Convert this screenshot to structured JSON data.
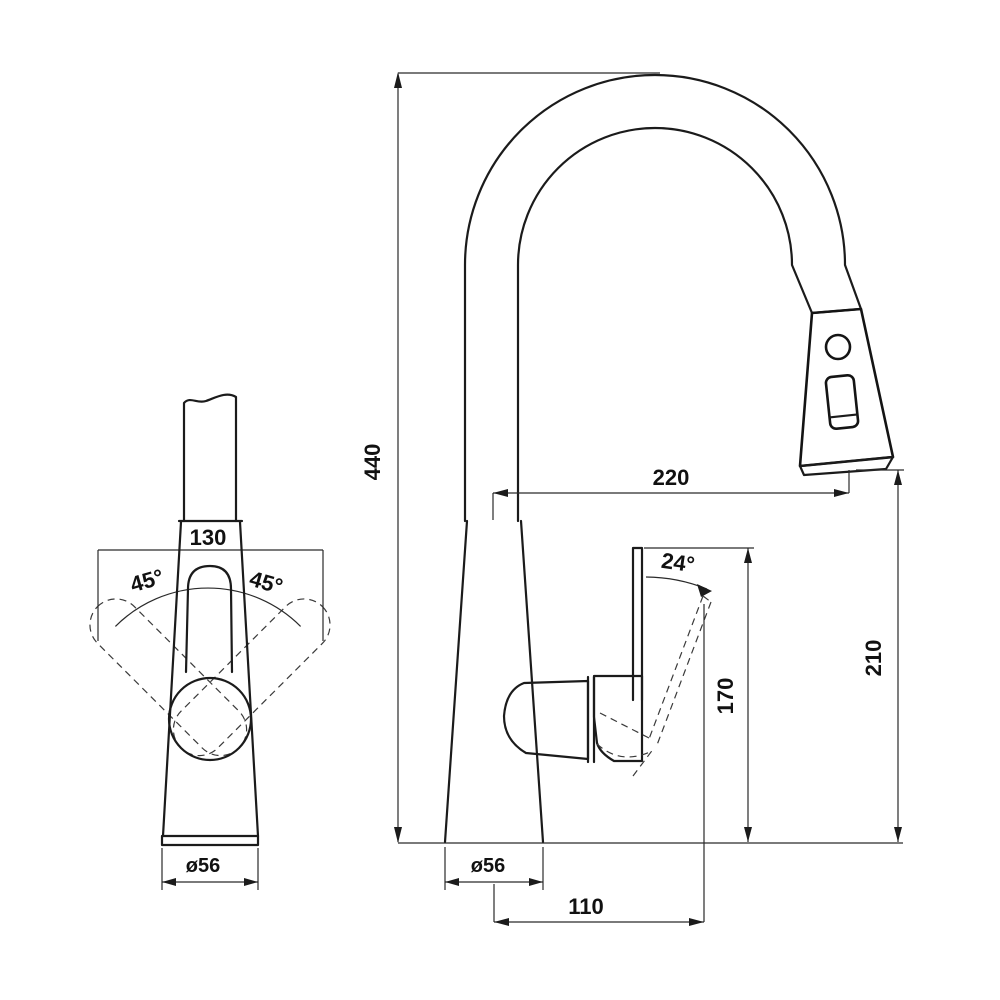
{
  "views": {
    "top_view": {
      "labels": {
        "spout_length": "130",
        "swivel_left": "45°",
        "swivel_right": "45°",
        "base_diameter": "ø56"
      }
    },
    "side_view": {
      "labels": {
        "total_height": "440",
        "spout_reach": "220",
        "handle_angle": "24°",
        "handle_height": "170",
        "outlet_height": "210",
        "base_diameter": "ø56",
        "handle_offset": "110"
      }
    }
  },
  "style": {
    "line_color": "#1b1b1b",
    "background": "#ffffff"
  }
}
